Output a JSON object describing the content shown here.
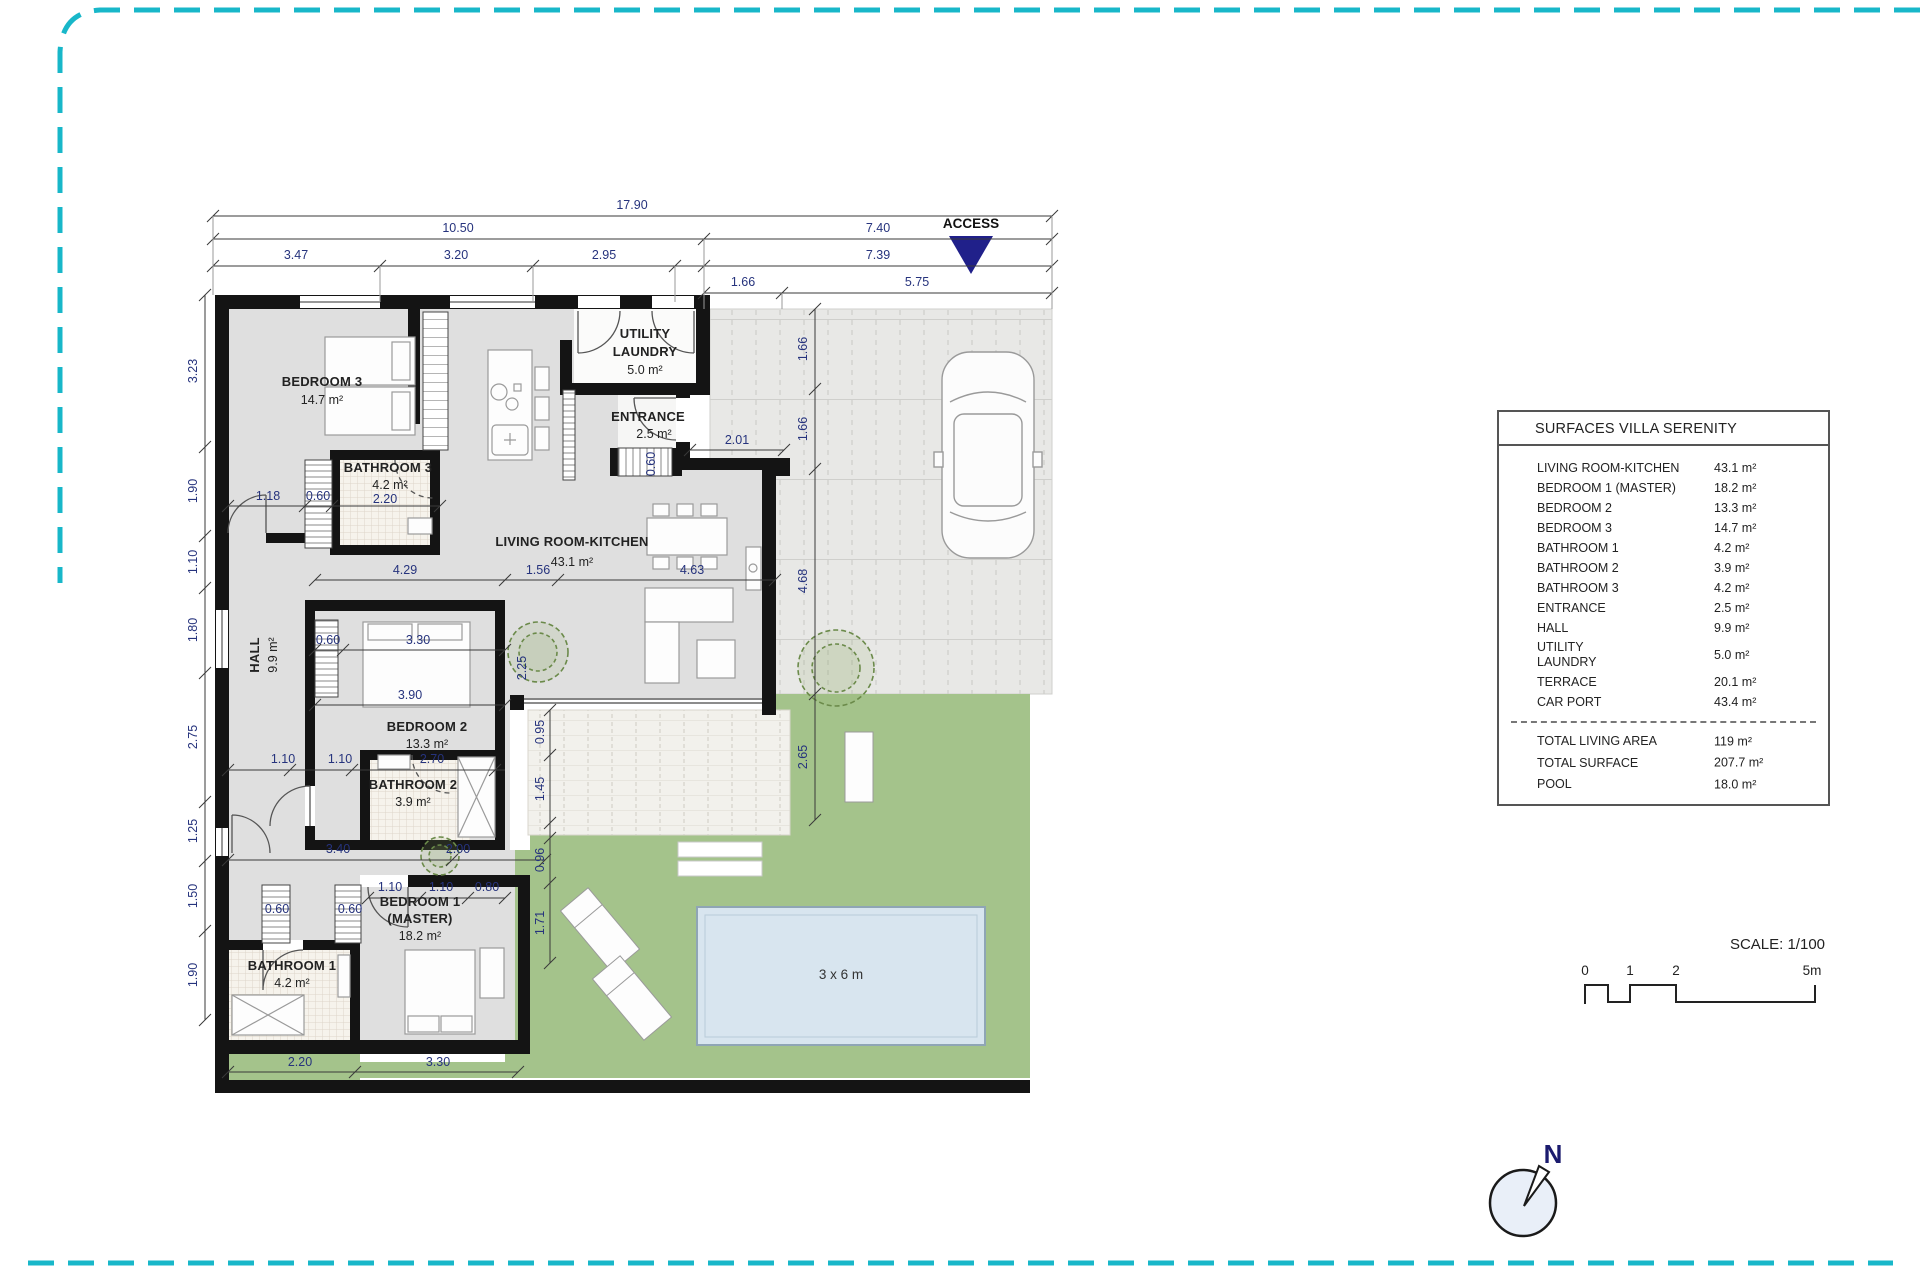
{
  "table": {
    "title": "SURFACES VILLA SERENITY",
    "rows": [
      {
        "label": "LIVING ROOM-KITCHEN",
        "value": "43.1 m²"
      },
      {
        "label": "BEDROOM 1 (MASTER)",
        "value": "18.2 m²"
      },
      {
        "label": "BEDROOM 2",
        "value": "13.3 m²"
      },
      {
        "label": "BEDROOM 3",
        "value": "14.7 m²"
      },
      {
        "label": "BATHROOM 1",
        "value": "4.2 m²"
      },
      {
        "label": "BATHROOM 2",
        "value": "3.9 m²"
      },
      {
        "label": "BATHROOM 3",
        "value": "4.2 m²"
      },
      {
        "label": "ENTRANCE",
        "value": "2.5 m²"
      },
      {
        "label": "HALL",
        "value": "9.9 m²"
      },
      {
        "label": "UTILITY\nLAUNDRY",
        "value": "5.0 m²",
        "tall": true
      },
      {
        "label": "TERRACE",
        "value": "20.1 m²"
      },
      {
        "label": "CAR PORT",
        "value": "43.4 m²"
      }
    ],
    "totals": [
      {
        "label": "TOTAL LIVING AREA",
        "value": "119 m²"
      },
      {
        "label": "TOTAL SURFACE",
        "value": "207.7 m²"
      },
      {
        "label": "POOL",
        "value": "18.0 m²"
      }
    ]
  },
  "colors": {
    "frame_dash": "#18b7c9",
    "access_triangle": "#20208a",
    "garden": "#a4c38b",
    "pool_water": "#d8e5ef",
    "wall": "#141414",
    "floor": "#dfdfdf",
    "dim_text": "#26337d"
  },
  "plan_labels": [
    {
      "t": "17.90",
      "x": 632,
      "y": 209,
      "c": "d"
    },
    {
      "t": "10.50",
      "x": 458,
      "y": 232,
      "c": "d"
    },
    {
      "t": "7.40",
      "x": 878,
      "y": 232,
      "c": "d"
    },
    {
      "t": "3.47",
      "x": 296,
      "y": 259,
      "c": "d"
    },
    {
      "t": "3.20",
      "x": 456,
      "y": 259,
      "c": "d"
    },
    {
      "t": "2.95",
      "x": 604,
      "y": 259,
      "c": "d"
    },
    {
      "t": "7.39",
      "x": 878,
      "y": 259,
      "c": "d"
    },
    {
      "t": "1.66",
      "x": 743,
      "y": 286,
      "c": "d"
    },
    {
      "t": "5.75",
      "x": 917,
      "y": 286,
      "c": "d"
    },
    {
      "t": "3.23",
      "x": 197,
      "y": 371,
      "c": "d",
      "r": -90
    },
    {
      "t": "1.90",
      "x": 197,
      "y": 491,
      "c": "d",
      "r": -90
    },
    {
      "t": "1.10",
      "x": 197,
      "y": 562,
      "c": "d",
      "r": -90
    },
    {
      "t": "1.80",
      "x": 197,
      "y": 630,
      "c": "d",
      "r": -90
    },
    {
      "t": "2.75",
      "x": 197,
      "y": 737,
      "c": "d",
      "r": -90
    },
    {
      "t": "1.25",
      "x": 197,
      "y": 831,
      "c": "d",
      "r": -90
    },
    {
      "t": "1.50",
      "x": 197,
      "y": 896,
      "c": "d",
      "r": -90
    },
    {
      "t": "1.90",
      "x": 197,
      "y": 975,
      "c": "d",
      "r": -90
    },
    {
      "t": "1.66",
      "x": 807,
      "y": 349,
      "c": "d",
      "r": -90
    },
    {
      "t": "1.66",
      "x": 807,
      "y": 429,
      "c": "d",
      "r": -90
    },
    {
      "t": "4.68",
      "x": 807,
      "y": 581,
      "c": "d",
      "r": -90
    },
    {
      "t": "2.65",
      "x": 807,
      "y": 757,
      "c": "d",
      "r": -90
    },
    {
      "t": "0.95",
      "x": 544,
      "y": 732,
      "c": "d",
      "r": -90
    },
    {
      "t": "1.45",
      "x": 544,
      "y": 789,
      "c": "d",
      "r": -90
    },
    {
      "t": "0.96",
      "x": 544,
      "y": 860,
      "c": "d",
      "r": -90
    },
    {
      "t": "1.71",
      "x": 544,
      "y": 923,
      "c": "d",
      "r": -90
    },
    {
      "t": "2.25",
      "x": 526,
      "y": 668,
      "c": "d",
      "r": -90
    },
    {
      "t": "1.18",
      "x": 268,
      "y": 500,
      "c": "d"
    },
    {
      "t": "0.60",
      "x": 318,
      "y": 500,
      "c": "d"
    },
    {
      "t": "2.20",
      "x": 385,
      "y": 503,
      "c": "d"
    },
    {
      "t": "2.01",
      "x": 737,
      "y": 444,
      "c": "d"
    },
    {
      "t": "0.60",
      "x": 655,
      "y": 464,
      "c": "d",
      "r": -90
    },
    {
      "t": "4.29",
      "x": 405,
      "y": 574,
      "c": "d"
    },
    {
      "t": "1.56",
      "x": 538,
      "y": 574,
      "c": "d"
    },
    {
      "t": "4.63",
      "x": 692,
      "y": 574,
      "c": "d"
    },
    {
      "t": "0.60",
      "x": 328,
      "y": 644,
      "c": "d"
    },
    {
      "t": "3.30",
      "x": 418,
      "y": 644,
      "c": "d"
    },
    {
      "t": "3.90",
      "x": 410,
      "y": 699,
      "c": "d"
    },
    {
      "t": "1.10",
      "x": 283,
      "y": 763,
      "c": "d"
    },
    {
      "t": "1.10",
      "x": 340,
      "y": 763,
      "c": "d"
    },
    {
      "t": "2.70",
      "x": 432,
      "y": 763,
      "c": "d"
    },
    {
      "t": "3.40",
      "x": 338,
      "y": 853,
      "c": "d"
    },
    {
      "t": "2.00",
      "x": 458,
      "y": 853,
      "c": "d"
    },
    {
      "t": "1.10",
      "x": 390,
      "y": 891,
      "c": "d"
    },
    {
      "t": "1.10",
      "x": 441,
      "y": 891,
      "c": "d"
    },
    {
      "t": "0.80",
      "x": 487,
      "y": 891,
      "c": "d"
    },
    {
      "t": "0.60",
      "x": 277,
      "y": 913,
      "c": "d"
    },
    {
      "t": "0.60",
      "x": 350,
      "y": 913,
      "c": "d"
    },
    {
      "t": "2.20",
      "x": 300,
      "y": 1066,
      "c": "d"
    },
    {
      "t": "3.30",
      "x": 438,
      "y": 1066,
      "c": "d"
    },
    {
      "t": "BEDROOM 3",
      "x": 322,
      "y": 386,
      "c": "r"
    },
    {
      "t": "14.7 m²",
      "x": 322,
      "y": 404,
      "c": "a"
    },
    {
      "t": "BATHROOM 3",
      "x": 388,
      "y": 472,
      "c": "r"
    },
    {
      "t": "4.2 m²",
      "x": 390,
      "y": 489,
      "c": "a"
    },
    {
      "t": "UTILITY",
      "x": 645,
      "y": 338,
      "c": "r"
    },
    {
      "t": "LAUNDRY",
      "x": 645,
      "y": 356,
      "c": "r"
    },
    {
      "t": "5.0 m²",
      "x": 645,
      "y": 374,
      "c": "a"
    },
    {
      "t": "ENTRANCE",
      "x": 648,
      "y": 421,
      "c": "r"
    },
    {
      "t": "2.5 m²",
      "x": 654,
      "y": 438,
      "c": "a"
    },
    {
      "t": "LIVING ROOM-KITCHEN",
      "x": 572,
      "y": 546,
      "c": "r"
    },
    {
      "t": "43.1 m²",
      "x": 572,
      "y": 566,
      "c": "a"
    },
    {
      "t": "HALL",
      "x": 259,
      "y": 655,
      "c": "r",
      "r": -90
    },
    {
      "t": "9.9 m²",
      "x": 277,
      "y": 655,
      "c": "a",
      "r": -90
    },
    {
      "t": "BEDROOM 2",
      "x": 427,
      "y": 731,
      "c": "r"
    },
    {
      "t": "13.3 m²",
      "x": 427,
      "y": 748,
      "c": "a"
    },
    {
      "t": "BATHROOM 2",
      "x": 413,
      "y": 789,
      "c": "r"
    },
    {
      "t": "3.9 m²",
      "x": 413,
      "y": 806,
      "c": "a"
    },
    {
      "t": "BEDROOM 1",
      "x": 420,
      "y": 906,
      "c": "r"
    },
    {
      "t": "(MASTER)",
      "x": 420,
      "y": 923,
      "c": "r"
    },
    {
      "t": "18.2 m²",
      "x": 420,
      "y": 940,
      "c": "a"
    },
    {
      "t": "BATHROOM 1",
      "x": 292,
      "y": 970,
      "c": "r"
    },
    {
      "t": "4.2 m²",
      "x": 292,
      "y": 987,
      "c": "a"
    },
    {
      "t": "3 x 6 m",
      "x": 841,
      "y": 979,
      "c": "pool"
    },
    {
      "t": "ACCESS",
      "x": 971,
      "y": 228,
      "c": "acc"
    },
    {
      "t": "N",
      "x": 1553,
      "y": 1163,
      "c": "north"
    },
    {
      "t": "SCALE: 1/100",
      "x": 1825,
      "y": 949,
      "c": "sct"
    },
    {
      "t": "0",
      "x": 1585,
      "y": 975,
      "c": "sc"
    },
    {
      "t": "1",
      "x": 1630,
      "y": 975,
      "c": "sc"
    },
    {
      "t": "2",
      "x": 1676,
      "y": 975,
      "c": "sc"
    },
    {
      "t": "5m",
      "x": 1812,
      "y": 975,
      "c": "sc"
    }
  ]
}
